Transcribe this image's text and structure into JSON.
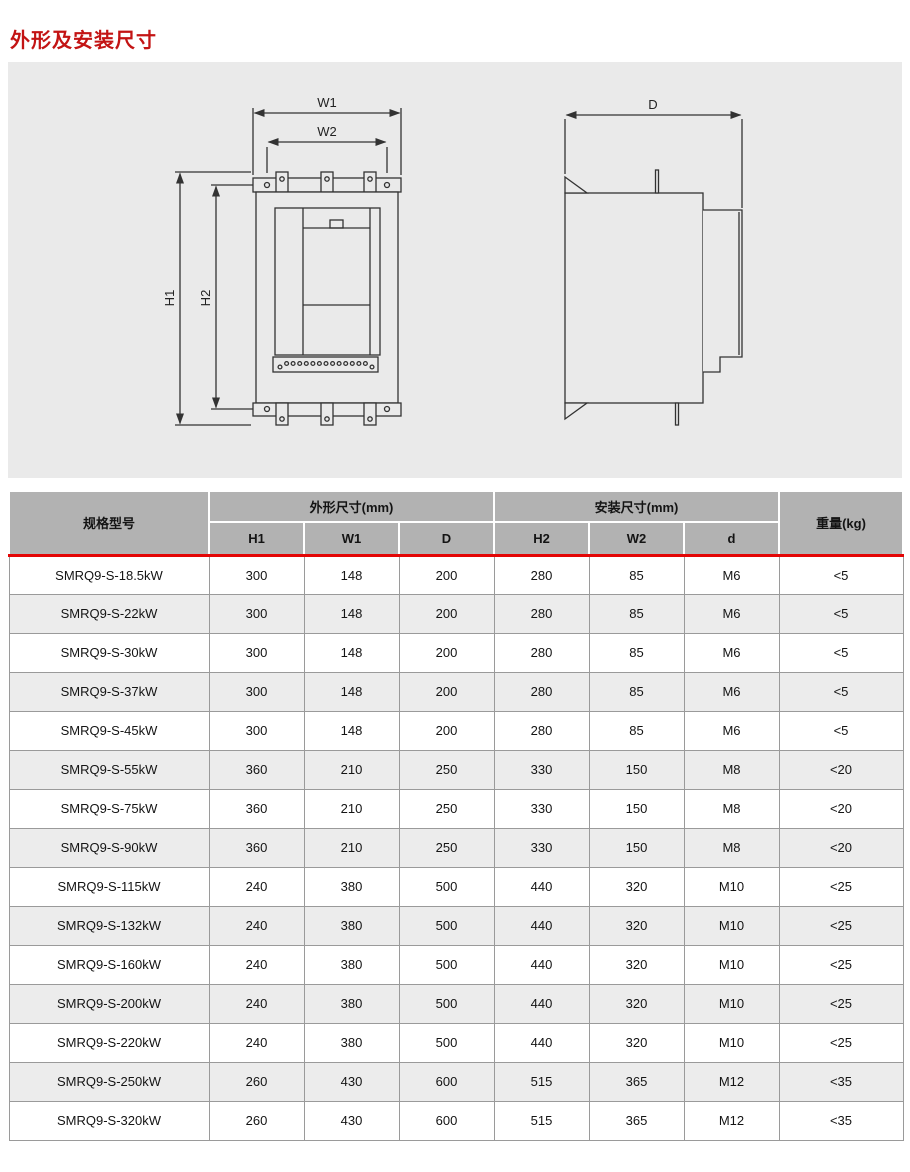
{
  "page": {
    "title": "外形及安装尺寸"
  },
  "diagram": {
    "labels": {
      "w1": "W1",
      "w2": "W2",
      "h1": "H1",
      "h2": "H2",
      "d": "D"
    }
  },
  "table": {
    "header": {
      "model": "规格型号",
      "outline_group": "外形尺寸(mm)",
      "mount_group": "安装尺寸(mm)",
      "weight": "重量(kg)",
      "sub": [
        "H1",
        "W1",
        "D",
        "H2",
        "W2",
        "d"
      ]
    },
    "rows": [
      {
        "model": "SMRQ9-S-18.5kW",
        "h1": "300",
        "w1": "148",
        "d_out": "200",
        "h2": "280",
        "w2": "85",
        "d": "M6",
        "weight": "<5"
      },
      {
        "model": "SMRQ9-S-22kW",
        "h1": "300",
        "w1": "148",
        "d_out": "200",
        "h2": "280",
        "w2": "85",
        "d": "M6",
        "weight": "<5"
      },
      {
        "model": "SMRQ9-S-30kW",
        "h1": "300",
        "w1": "148",
        "d_out": "200",
        "h2": "280",
        "w2": "85",
        "d": "M6",
        "weight": "<5"
      },
      {
        "model": "SMRQ9-S-37kW",
        "h1": "300",
        "w1": "148",
        "d_out": "200",
        "h2": "280",
        "w2": "85",
        "d": "M6",
        "weight": "<5"
      },
      {
        "model": "SMRQ9-S-45kW",
        "h1": "300",
        "w1": "148",
        "d_out": "200",
        "h2": "280",
        "w2": "85",
        "d": "M6",
        "weight": "<5"
      },
      {
        "model": "SMRQ9-S-55kW",
        "h1": "360",
        "w1": "210",
        "d_out": "250",
        "h2": "330",
        "w2": "150",
        "d": "M8",
        "weight": "<20"
      },
      {
        "model": "SMRQ9-S-75kW",
        "h1": "360",
        "w1": "210",
        "d_out": "250",
        "h2": "330",
        "w2": "150",
        "d": "M8",
        "weight": "<20"
      },
      {
        "model": "SMRQ9-S-90kW",
        "h1": "360",
        "w1": "210",
        "d_out": "250",
        "h2": "330",
        "w2": "150",
        "d": "M8",
        "weight": "<20"
      },
      {
        "model": "SMRQ9-S-115kW",
        "h1": "240",
        "w1": "380",
        "d_out": "500",
        "h2": "440",
        "w2": "320",
        "d": "M10",
        "weight": "<25"
      },
      {
        "model": "SMRQ9-S-132kW",
        "h1": "240",
        "w1": "380",
        "d_out": "500",
        "h2": "440",
        "w2": "320",
        "d": "M10",
        "weight": "<25"
      },
      {
        "model": "SMRQ9-S-160kW",
        "h1": "240",
        "w1": "380",
        "d_out": "500",
        "h2": "440",
        "w2": "320",
        "d": "M10",
        "weight": "<25"
      },
      {
        "model": "SMRQ9-S-200kW",
        "h1": "240",
        "w1": "380",
        "d_out": "500",
        "h2": "440",
        "w2": "320",
        "d": "M10",
        "weight": "<25"
      },
      {
        "model": "SMRQ9-S-220kW",
        "h1": "240",
        "w1": "380",
        "d_out": "500",
        "h2": "440",
        "w2": "320",
        "d": "M10",
        "weight": "<25"
      },
      {
        "model": "SMRQ9-S-250kW",
        "h1": "260",
        "w1": "430",
        "d_out": "600",
        "h2": "515",
        "w2": "365",
        "d": "M12",
        "weight": "<35"
      },
      {
        "model": "SMRQ9-S-320kW",
        "h1": "260",
        "w1": "430",
        "d_out": "600",
        "h2": "515",
        "w2": "365",
        "d": "M12",
        "weight": "<35"
      }
    ]
  },
  "colors": {
    "title_red": "#c31414",
    "accent_red_line": "#e30505",
    "header_gray": "#b2b2b2",
    "row_alt_gray": "#ececec",
    "panel_gray": "#eaeaea",
    "line_dark": "#333333"
  }
}
